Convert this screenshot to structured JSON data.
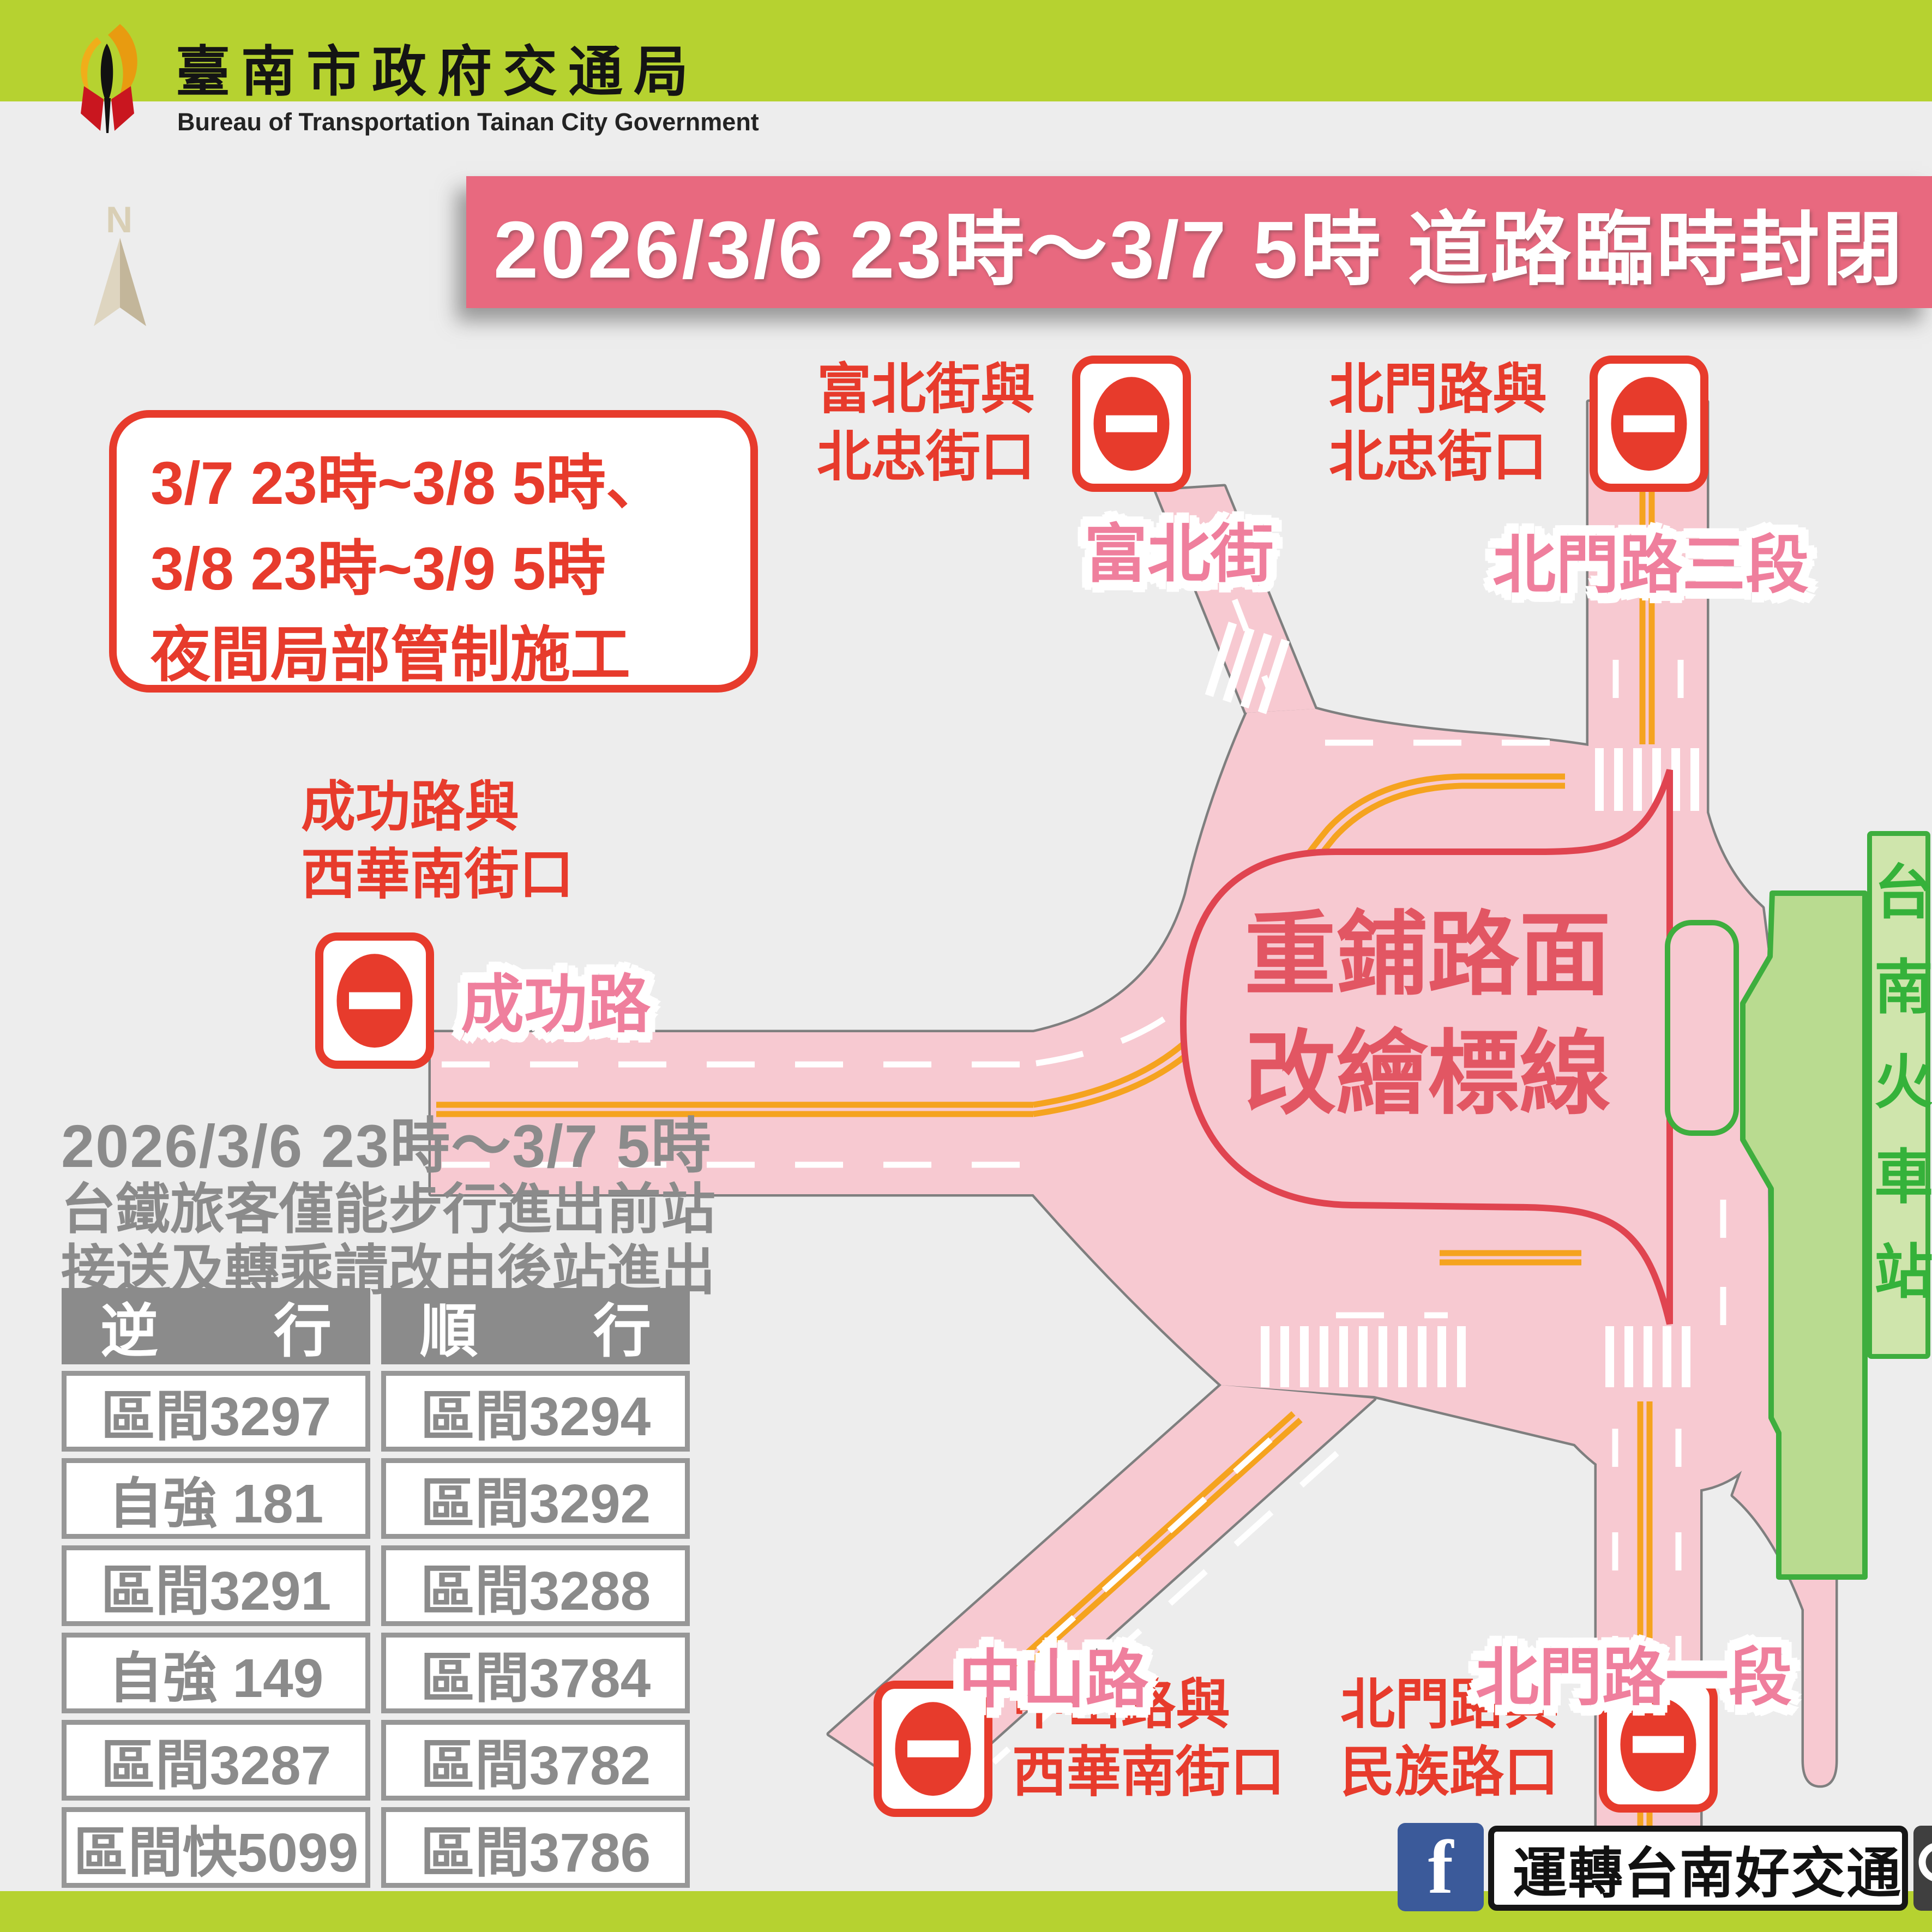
{
  "header": {
    "title": "臺南市政府交通局",
    "subtitle": "Bureau of Transportation Tainan City Government"
  },
  "banner": {
    "text": "2026/3/6 23時～3/7 5時 道路臨時封閉"
  },
  "compass": {
    "label": "N"
  },
  "notice_box": {
    "text": "3/7 23時~3/8 5時、\n3/8 23時~3/9 5時\n夜間局部管制施工"
  },
  "closures": {
    "fubei_beizhong": "富北街與\n北忠街口",
    "beimen_beizhong": "北門路與\n北忠街口",
    "chenggong_xihuanan": "成功路與\n西華南街口",
    "zhongshan_xihuanan": "中山路與\n西華南街口",
    "beimen_minzu": "北門路與\n民族路口"
  },
  "streets": {
    "fubei": "富北街",
    "beimen_sec3": "北門路三段",
    "chenggong": "成功路",
    "zhongshan": "中山路",
    "beimen_sec1": "北門路一段"
  },
  "construction_zone": {
    "text": "重鋪路面\n改繪標線"
  },
  "station": {
    "name": "台南火車站"
  },
  "rail_notice": {
    "line1": "2026/3/6 23時～3/7 5時",
    "line2": "台鐵旅客僅能步行進出前站",
    "line3": "接送及轉乘請改由後站進出"
  },
  "train_table": {
    "headers": [
      "逆　　行",
      "順　　行"
    ],
    "rows": [
      [
        "區間3297",
        "區間3294"
      ],
      [
        "自強 181",
        "區間3292"
      ],
      [
        "區間3291",
        "區間3288"
      ],
      [
        "自強 149",
        "區間3784"
      ],
      [
        "區間3287",
        "區間3782"
      ],
      [
        "區間快5099",
        "區間3786"
      ]
    ]
  },
  "footer": {
    "facebook_letter": "f",
    "page_name": "運轉台南好交通"
  },
  "colors": {
    "lime_border": "#b6d230",
    "banner_pink": "#e8697f",
    "alert_red": "#e73b2c",
    "road_pink": "#f7c9d1",
    "road_edge_gray": "#7f7f7f",
    "center_line_orange": "#f5a31f",
    "street_label_pink": "#ef7f9d",
    "island_red": "#e04450",
    "station_green": "#3eae3e",
    "station_fill": "#b9db90",
    "gray_text": "#8b8b8b",
    "facebook_blue": "#3b5a9a"
  }
}
